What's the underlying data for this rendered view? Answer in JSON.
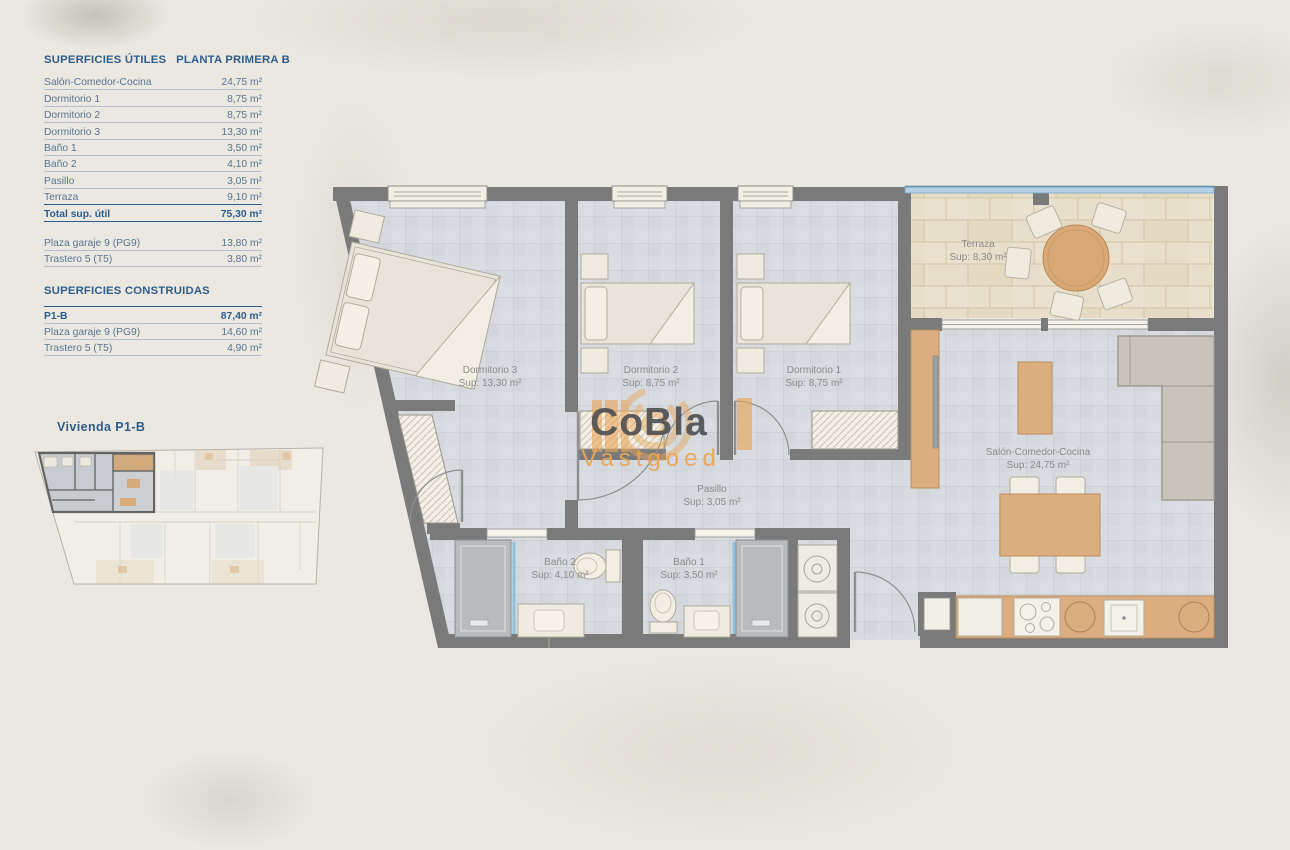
{
  "panel": {
    "title": "SUPERFICIES ÚTILES",
    "plan_title": "PLANTA PRIMERA B",
    "useful_rows": [
      {
        "label": "Salón-Comedor-Cocina",
        "value": "24,75 m²"
      },
      {
        "label": "Dormitorio 1",
        "value": "8,75 m²"
      },
      {
        "label": "Dormitorio 2",
        "value": "8,75 m²"
      },
      {
        "label": "Dormitorio 3",
        "value": "13,30 m²"
      },
      {
        "label": "Baño 1",
        "value": "3,50 m²"
      },
      {
        "label": "Baño 2",
        "value": "4,10 m²"
      },
      {
        "label": "Pasillo",
        "value": "3,05 m²"
      },
      {
        "label": "Terraza",
        "value": "9,10 m²"
      }
    ],
    "total_row": {
      "label": "Total sup. útil",
      "value": "75,30 m²"
    },
    "annex_rows": [
      {
        "label": "Plaza garaje 9 (PG9)",
        "value": "13,80 m²"
      },
      {
        "label": "Trastero 5 (T5)",
        "value": "3,80 m²"
      }
    ],
    "built_title": "SUPERFICIES CONSTRUIDAS",
    "built_rows": [
      {
        "label": "P1-B",
        "value": "87,40 m²"
      },
      {
        "label": "Plaza garaje 9 (PG9)",
        "value": "14,60 m²"
      },
      {
        "label": "Trastero 5 (T5)",
        "value": "4,90 m²"
      }
    ],
    "overview_title": "Vivienda P1-B"
  },
  "plan": {
    "rooms": [
      {
        "name": "Dormitorio 3",
        "sup": "Sup: 13,30 m²"
      },
      {
        "name": "Dormitorio 2",
        "sup": "Sup: 8,75 m²"
      },
      {
        "name": "Dormitorio 1",
        "sup": "Sup: 8,75 m²"
      },
      {
        "name": "Terraza",
        "sup": "Sup: 8,30 m²"
      },
      {
        "name": "Salón-Comedor-Cocina",
        "sup": "Sup: 24,75 m²"
      },
      {
        "name": "Pasillo",
        "sup": "Sup: 3,05 m²"
      },
      {
        "name": "Baño 2",
        "sup": "Sup: 4,10 m²"
      },
      {
        "name": "Baño 1",
        "sup": "Sup: 3,50 m²"
      }
    ]
  },
  "watermark": {
    "brand": "CoBla",
    "sub": "Vastgoed"
  },
  "colors": {
    "heading_blue": "#2e5d8c",
    "wall_gray": "#7a7a7a",
    "floor_tile": "#d7dade",
    "terrace_tile": "#e7dfc9",
    "wood": "#dcae7f",
    "logo_gray": "#55565a",
    "logo_orange": "#e9a455",
    "railing_blue": "#b3d2e6"
  }
}
